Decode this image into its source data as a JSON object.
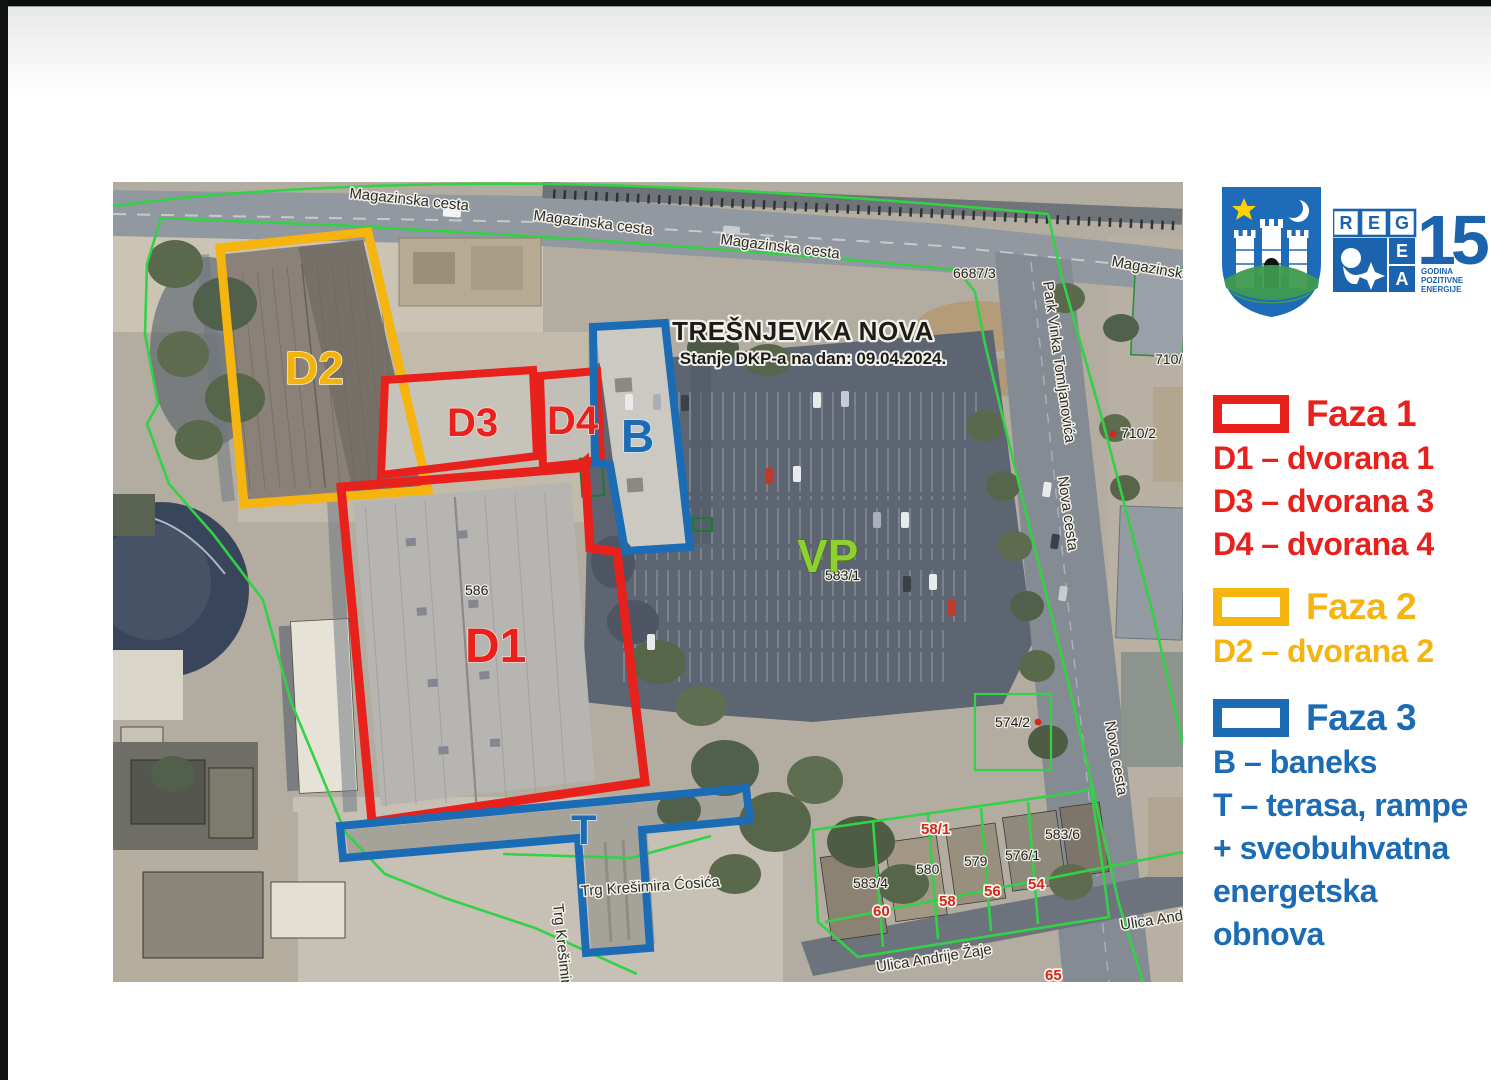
{
  "map": {
    "title": "TREŠNJEVKA NOVA",
    "subtitle": "Stanje DKP-a na dan: 09.04.2024.",
    "areas": {
      "d1": "D1",
      "d2": "D2",
      "d3": "D3",
      "d4": "D4",
      "b": "B",
      "t": "T",
      "vp": "VP"
    },
    "streets": {
      "magazinska_1": "Magazinska cesta",
      "magazinska_2": "Magazinska cesta",
      "magazinska_3": "Magazinska cesta",
      "magazinska_4": "Magazinska",
      "park_vinka": "Park Vinka Tomljanovića",
      "nova_1": "Nova cesta",
      "nova_2": "Nova cesta",
      "trg_h": "Trg Krešimira Ćosića",
      "trg_v": "Trg Krešimira",
      "andrije": "Ulica Andrije Žaje",
      "andr_partial": "Ulica Andr"
    },
    "parcels": {
      "n6687_3": "6687/3",
      "n710": "710/",
      "n710_2": "710/2",
      "n586": "586",
      "n583_1": "583/1",
      "n574_2": "574/2",
      "n58_1": "58/1",
      "n583_4": "583/4",
      "n580": "580",
      "n579": "579",
      "n576_1": "576/1",
      "n583_6": "583/6"
    },
    "house_numbers": {
      "h60": "60",
      "h58": "58",
      "h56": "56",
      "h54": "54",
      "h65": "65"
    }
  },
  "legend": {
    "phase1": {
      "title": "Faza 1",
      "color": "#e8211c",
      "items": [
        "D1 – dvorana 1",
        "D3 – dvorana 3",
        "D4 – dvorana 4"
      ]
    },
    "phase2": {
      "title": "Faza 2",
      "color": "#f5b40e",
      "items": [
        "D2 – dvorana 2"
      ]
    },
    "phase3": {
      "title": "Faza 3",
      "color": "#1c6cb5",
      "items": [
        "B – baneks",
        "T – terasa, rampe",
        "+ sveobuhvatna",
        "energetska",
        "obnova"
      ]
    }
  },
  "logos": {
    "regea": {
      "r": "R",
      "e1": "E",
      "g": "G",
      "e2": "E",
      "a": "A",
      "fifteen": "15",
      "tagline1": "GODINA",
      "tagline2": "POZITIVNE",
      "tagline3": "ENERGIJE"
    }
  },
  "colors": {
    "phase1": "#e8211c",
    "phase2": "#f5b40e",
    "phase3": "#1c6cb5",
    "cadastral": "#33d146",
    "vp_green": "#8ed031"
  }
}
